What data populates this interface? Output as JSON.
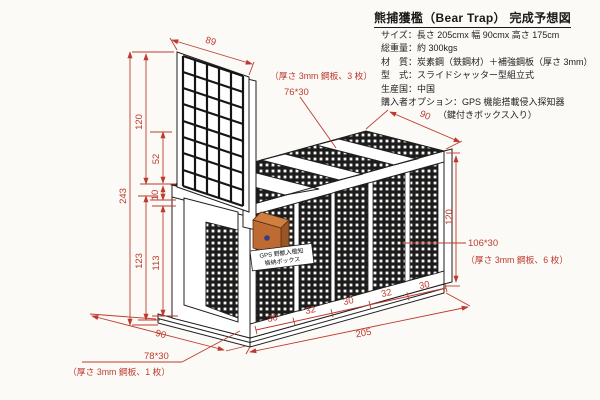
{
  "title": "熊捕獲檻（Bear Trap） 完成予想図",
  "specs": [
    "サイズ：長さ 205cmx 幅 90cmx 高さ 175cm",
    "総重量：約 300kgs",
    "材　質：炭素鋼（鉄鋼材）＋補強鋼板（厚さ 3mm）",
    "型　式：スライドシャッター型組立式",
    "生産国：中国",
    "購入者オプション：GPS 機能搭載侵入探知器",
    "（鍵付きボックス入り）"
  ],
  "dim_labels": {
    "shutter_width": "89",
    "total_height": "243",
    "shutter_height": "120",
    "upper_gap": "52",
    "lower_gap": "10",
    "door_outer": "123",
    "door_inner": "113",
    "top_width": "90",
    "side_height": "120",
    "base_width": "90",
    "total_length": "205",
    "segments": [
      "30",
      "32",
      "30",
      "32",
      "30"
    ]
  },
  "annotations": {
    "roof_plate": "76*30",
    "roof_note": "（厚さ 3mm 鋼板、3 枚）",
    "side_plate": "106*30",
    "side_note": "（厚さ 3mm 鋼板、6 枚）",
    "floor_plate": "78*30",
    "floor_note": "（厚さ 3mm 鋼板、1 枚）"
  },
  "gps_box": {
    "line1": "GPS 野獣入檻知",
    "line2": "格納ボックス"
  },
  "colors": {
    "dimension_red": "#bf3a2e",
    "linework": "#1f1f1f",
    "box_orange": "#c06a33",
    "paper": "#fbfaf7"
  }
}
